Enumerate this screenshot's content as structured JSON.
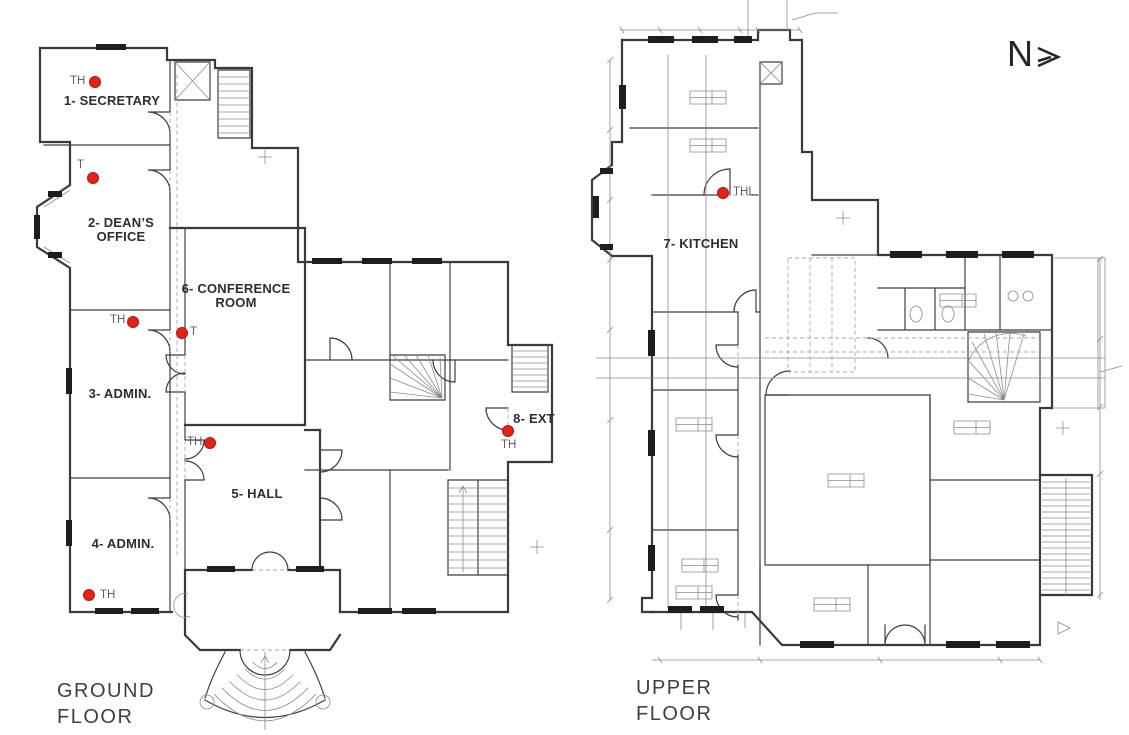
{
  "drawing": {
    "north_indicator": {
      "label": "N"
    },
    "colors": {
      "sensor_dot": "#E02419",
      "linework": "#3A3A3A",
      "room_label_text": "#2E2E2E",
      "sensor_label_text": "#606060",
      "floor_title_text": "#404040"
    },
    "ground_floor": {
      "title_lines": [
        "GROUND",
        "FLOOR"
      ],
      "rooms": [
        {
          "id": "secretary",
          "label_lines": [
            "1- SECRETARY"
          ]
        },
        {
          "id": "deans-office",
          "label_lines": [
            "2- DEAN’S",
            "OFFICE"
          ]
        },
        {
          "id": "conference-room",
          "label_lines": [
            "6- CONFERENCE",
            "ROOM"
          ]
        },
        {
          "id": "admin-3",
          "label_lines": [
            "3- ADMIN."
          ]
        },
        {
          "id": "hall",
          "label_lines": [
            "5- HALL"
          ]
        },
        {
          "id": "admin-4",
          "label_lines": [
            "4- ADMIN."
          ]
        },
        {
          "id": "ext",
          "label_lines": [
            "8- EXT"
          ]
        }
      ],
      "sensors": [
        {
          "type": "TH",
          "room": "1- SECRETARY"
        },
        {
          "type": "T",
          "room": "2- DEAN’S OFFICE"
        },
        {
          "type": "TH",
          "room": "3- ADMIN."
        },
        {
          "type": "T",
          "room": "6- CONFERENCE ROOM"
        },
        {
          "type": "TH",
          "room": "5- HALL"
        },
        {
          "type": "TH",
          "room": "4- ADMIN."
        },
        {
          "type": "TH",
          "room": "8- EXT"
        }
      ]
    },
    "upper_floor": {
      "title_lines": [
        "UPPER",
        "FLOOR"
      ],
      "rooms": [
        {
          "id": "kitchen",
          "label_lines": [
            "7- KITCHEN"
          ]
        }
      ],
      "sensors": [
        {
          "type": "THL",
          "room": "7- KITCHEN"
        }
      ]
    }
  }
}
